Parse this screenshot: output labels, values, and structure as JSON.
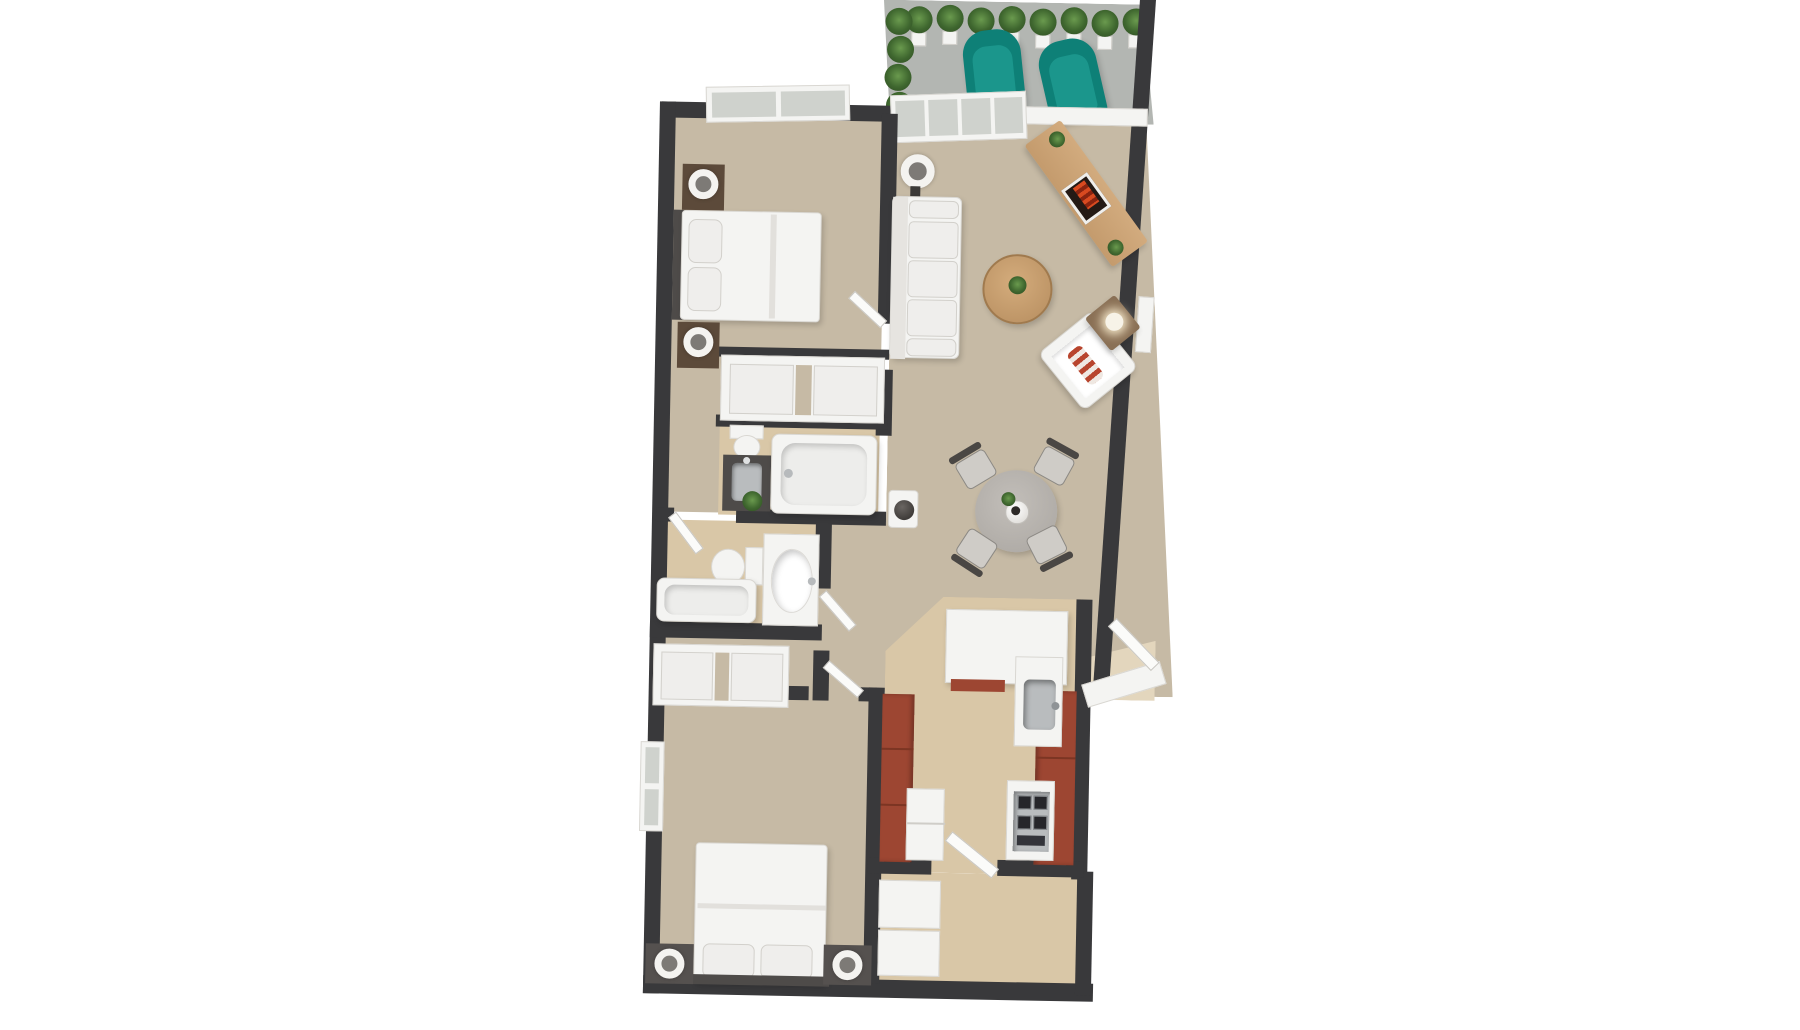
{
  "meta": {
    "kind": "3d-floor-plan-render",
    "visible_text": "none",
    "view": "top-down 3D dollhouse"
  },
  "colors": {
    "wall": "#39393b",
    "carpet": "#c6baa5",
    "wood": "#d9c7a7",
    "concrete": "#b3b6b2",
    "fixwhite": "#f4f4f2",
    "teal": "#0e8077",
    "tealdark": "#0a6b64",
    "cabred": "#9d4632",
    "woodfurn": "#c49b6d",
    "darkfix": "#4e4b49",
    "steel": "#b9bcbe",
    "tablegray": "#b5b1ac",
    "plantdark": "#3f672f",
    "flame": "#d84a20"
  },
  "rooms": {
    "balcony": {
      "label": "Balcony with potted plants and two teal armchairs"
    },
    "bedroom1": {
      "label": "Bedroom 1 with double bed, nightstands, closet and window"
    },
    "living": {
      "label": "Living and dining room with sofa, fireplace console, armchair and round dining table"
    },
    "bathA": {
      "label": "En-suite bathroom with toilet, vanity sink and bathtub"
    },
    "bathB": {
      "label": "Second bathroom with bathtub, toilet and oval sink vanity"
    },
    "bedroom2": {
      "label": "Bedroom 2 with double bed, nightstands, closet and window"
    },
    "kitchen": {
      "label": "Galley kitchen with red-brown cabinets, sink, cooktop and fridge"
    },
    "laundry": {
      "label": "Entry and laundry room with stacked white appliances"
    }
  },
  "furniture": {
    "balcony": [
      "potted-plants-row",
      "teal-armchair",
      "teal-armchair",
      "sliding-glass-door"
    ],
    "bedroom1": [
      "double-bed",
      "nightstand-lamp",
      "nightstand-lamp",
      "sliding-door-closet",
      "window"
    ],
    "living": [
      "white-sofa",
      "floor-lamp",
      "fireplace-media-console",
      "round-coffee-table",
      "white-armchair",
      "side-table-lamp",
      "dining-table-4-chairs",
      "pedestal-vase",
      "window"
    ],
    "bathA": [
      "toilet",
      "dark-vanity-sink",
      "bathtub",
      "plant"
    ],
    "bathB": [
      "bathtub",
      "toilet",
      "oval-sink-vanity"
    ],
    "bedroom2": [
      "double-bed",
      "nightstand-lamp",
      "nightstand-lamp",
      "sliding-door-closet",
      "window"
    ],
    "kitchen": [
      "red-cabinet-run",
      "fridge",
      "counter-peninsula",
      "kitchen-sink",
      "gas-cooktop"
    ],
    "laundry": [
      "washer",
      "dryer",
      "door"
    ]
  }
}
